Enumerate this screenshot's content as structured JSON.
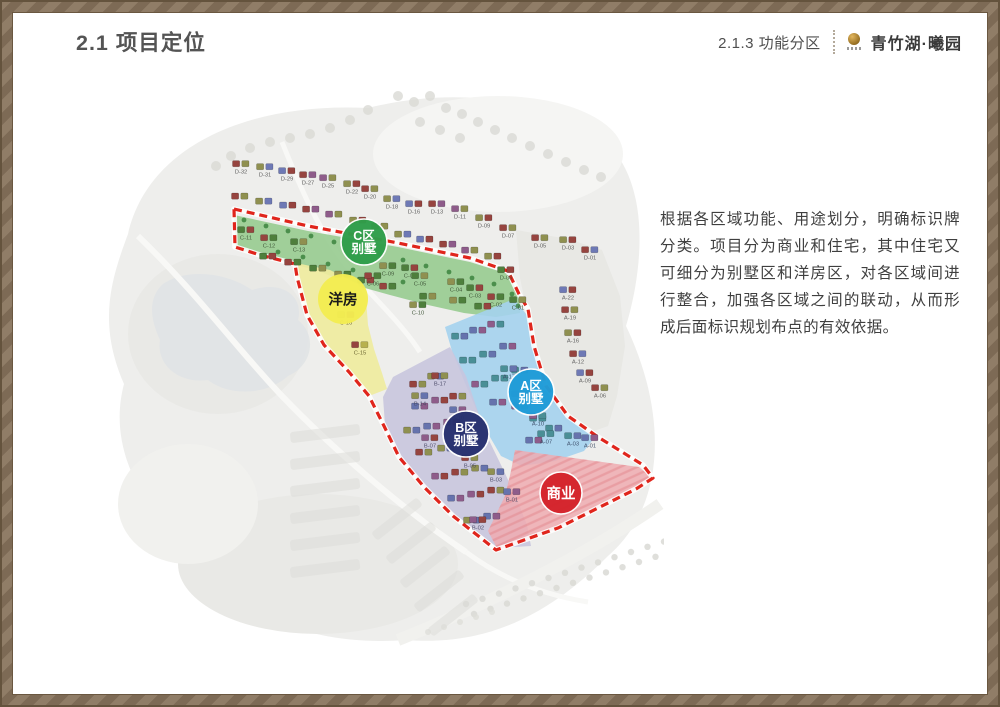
{
  "slide": {
    "title": "2.1 项目定位",
    "section": "2.1.3 功能分区",
    "brand": "青竹湖·曦园",
    "description": "根据各区域功能、用途划分，明确标识牌分类。项目分为商业和住宅，其中住宅又可细分为别墅区和洋房区，对各区域间进行整合，加强各区域之间的联动，从而形成后面标识规划布点的有效依据。"
  },
  "colors": {
    "frame": "#86735e"
  },
  "map": {
    "colors": {
      "boundary": "#e0251c",
      "zone_green": "#97cb90",
      "zone_yellow": "#efeb9e",
      "zone_blue": "#a4d2ee",
      "zone_lavender": "#c8c5de",
      "zone_pink": "#eeacb1"
    },
    "zone_badges": [
      {
        "id": "c-villa",
        "lines": [
          "C区",
          "别墅"
        ],
        "x": 296,
        "y": 158,
        "r": 23,
        "fill": "#2f9e4a",
        "text": "#ffffff",
        "stroke": "#ffffff"
      },
      {
        "id": "yangfang",
        "lines": [
          "洋房"
        ],
        "x": 275,
        "y": 215,
        "r": 25,
        "fill": "#f3ec52",
        "text": "#1a1a1a",
        "stroke": "none"
      },
      {
        "id": "a-villa",
        "lines": [
          "A区",
          "别墅"
        ],
        "x": 463,
        "y": 308,
        "r": 23,
        "fill": "#1f9cd8",
        "text": "#ffffff",
        "stroke": "#ffffff"
      },
      {
        "id": "b-villa",
        "lines": [
          "B区",
          "别墅"
        ],
        "x": 398,
        "y": 350,
        "r": 23,
        "fill": "#26306f",
        "text": "#ffffff",
        "stroke": "#ffffff"
      },
      {
        "id": "shangye",
        "lines": [
          "商业"
        ],
        "x": 493,
        "y": 409,
        "r": 21,
        "fill": "#d5232b",
        "text": "#ffffff",
        "stroke": "#ffffff"
      }
    ],
    "unit_labels": {
      "d_row": [
        [
          "D-32",
          173,
          86
        ],
        [
          "D-31",
          197,
          89
        ],
        [
          "D-29",
          219,
          93
        ],
        [
          "D-27",
          240,
          97
        ],
        [
          "D-25",
          260,
          100
        ],
        [
          "D-22",
          284,
          106
        ],
        [
          "D-20",
          302,
          111
        ],
        [
          "D-18",
          324,
          121
        ],
        [
          "D-16",
          346,
          126
        ],
        [
          "D-13",
          369,
          126
        ],
        [
          "D-11",
          392,
          131
        ],
        [
          "D-09",
          416,
          140
        ],
        [
          "D-07",
          440,
          150
        ]
      ],
      "right_col": [
        [
          "D-05",
          472,
          160
        ],
        [
          "D-03",
          500,
          162
        ],
        [
          "D-01",
          522,
          172
        ],
        [
          "A-22",
          500,
          212
        ],
        [
          "A-19",
          502,
          232
        ],
        [
          "A-16",
          505,
          255
        ],
        [
          "A-12",
          510,
          276
        ],
        [
          "A-09",
          517,
          295
        ],
        [
          "A-06",
          532,
          310
        ]
      ],
      "c_zone": [
        [
          "C-11",
          178,
          152
        ],
        [
          "C-12",
          201,
          160
        ],
        [
          "C-13",
          231,
          164
        ],
        [
          "C-09",
          320,
          188
        ],
        [
          "C-08",
          342,
          190
        ],
        [
          "C-06",
          305,
          198
        ],
        [
          "C-05",
          352,
          198
        ],
        [
          "C-04",
          388,
          204
        ],
        [
          "C-03",
          407,
          210
        ],
        [
          "C-02",
          428,
          219
        ],
        [
          "C-01",
          450,
          222
        ],
        [
          "C-10",
          350,
          227
        ],
        [
          "D-06",
          438,
          192
        ]
      ],
      "yang_zone": [
        [
          "C-16",
          278,
          237
        ],
        [
          "C-15",
          292,
          267
        ]
      ],
      "a_zone": [
        [
          "A-17",
          441,
          291
        ],
        [
          "A-14",
          452,
          316
        ],
        [
          "A-10",
          470,
          338
        ],
        [
          "A-07",
          478,
          356
        ],
        [
          "A-03",
          505,
          358
        ],
        [
          "A-01",
          522,
          360
        ]
      ],
      "b_zone": [
        [
          "B-17",
          372,
          298
        ],
        [
          "B-14",
          352,
          318
        ],
        [
          "B-10",
          390,
          332
        ],
        [
          "B-07",
          362,
          360
        ],
        [
          "B-05",
          402,
          380
        ],
        [
          "B-03",
          428,
          394
        ],
        [
          "B-01",
          444,
          414
        ],
        [
          "B-02",
          410,
          442
        ]
      ]
    }
  }
}
